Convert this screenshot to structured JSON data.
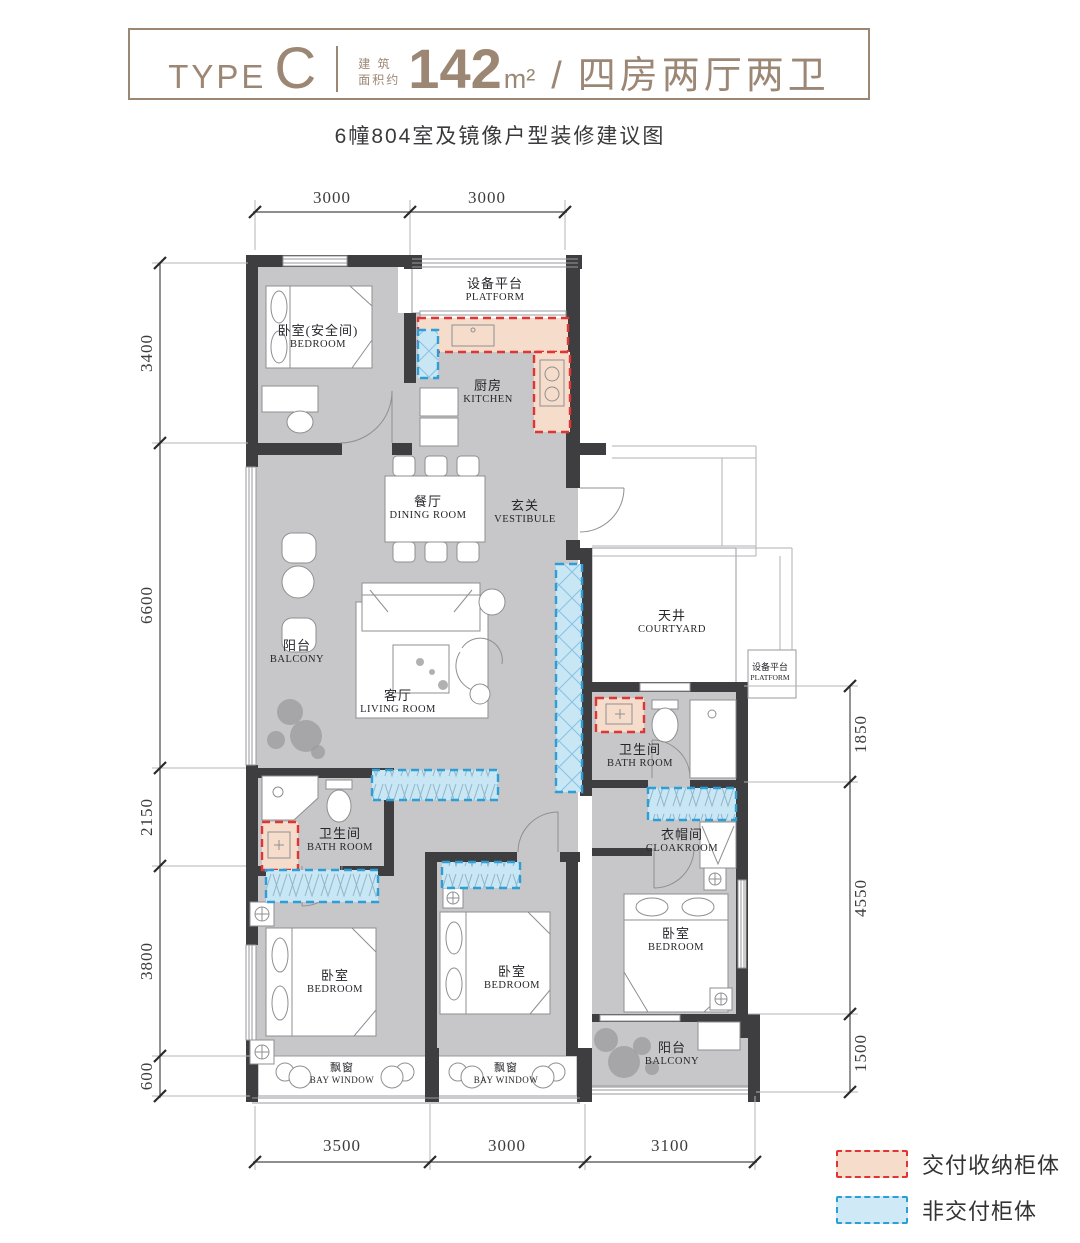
{
  "header": {
    "type_label": "TYPE",
    "type_value": "C",
    "area_label_line1": "建 筑",
    "area_label_line2": "面积约",
    "area_value": "142",
    "area_unit": "m²",
    "separator": "/",
    "layout": "四房两厅两卫"
  },
  "subtitle": "6幢804室及镜像户型装修建议图",
  "rooms": [
    {
      "cn": "卧室(安全间)",
      "en": "BEDROOM"
    },
    {
      "cn": "设备平台",
      "en": "PLATFORM"
    },
    {
      "cn": "厨房",
      "en": "KITCHEN"
    },
    {
      "cn": "餐厅",
      "en": "DINING ROOM"
    },
    {
      "cn": "玄关",
      "en": "VESTIBULE"
    },
    {
      "cn": "阳台",
      "en": "BALCONY"
    },
    {
      "cn": "客厅",
      "en": "LIVING ROOM"
    },
    {
      "cn": "天井",
      "en": "COURTYARD"
    },
    {
      "cn": "设备平台",
      "en": "PLATFORM"
    },
    {
      "cn": "卫生间",
      "en": "BATH ROOM"
    },
    {
      "cn": "衣帽间",
      "en": "CLOAKROOM"
    },
    {
      "cn": "卫生间",
      "en": "BATH ROOM"
    },
    {
      "cn": "卧室",
      "en": "BEDROOM"
    },
    {
      "cn": "卧室",
      "en": "BEDROOM"
    },
    {
      "cn": "卧室",
      "en": "BEDROOM"
    },
    {
      "cn": "飘窗",
      "en": "BAY WINDOW"
    },
    {
      "cn": "飘窗",
      "en": "BAY WINDOW"
    },
    {
      "cn": "阳台",
      "en": "BALCONY"
    }
  ],
  "dimensions": {
    "top": [
      "3000",
      "3000"
    ],
    "left": [
      "3400",
      "6600",
      "2150",
      "3800",
      "600"
    ],
    "right": [
      "1850",
      "4550",
      "1500"
    ],
    "bottom": [
      "3500",
      "3000",
      "3100"
    ]
  },
  "legend": [
    {
      "label": "交付收纳柜体",
      "fill": "#f6dccb",
      "border": "#e03535"
    },
    {
      "label": "非交付柜体",
      "fill": "#cfe9f6",
      "border": "#2d9fd6"
    }
  ],
  "colors": {
    "accent_brown": "#9c8775",
    "floor_gray": "#c7c7c9",
    "wall_dark": "#3e3e40",
    "delivered_cabinet_fill": "#f6dccb",
    "delivered_cabinet_border": "#e03535",
    "non_delivered_cabinet_fill": "#cfe9f6",
    "non_delivered_cabinet_border": "#2d9fd6"
  }
}
